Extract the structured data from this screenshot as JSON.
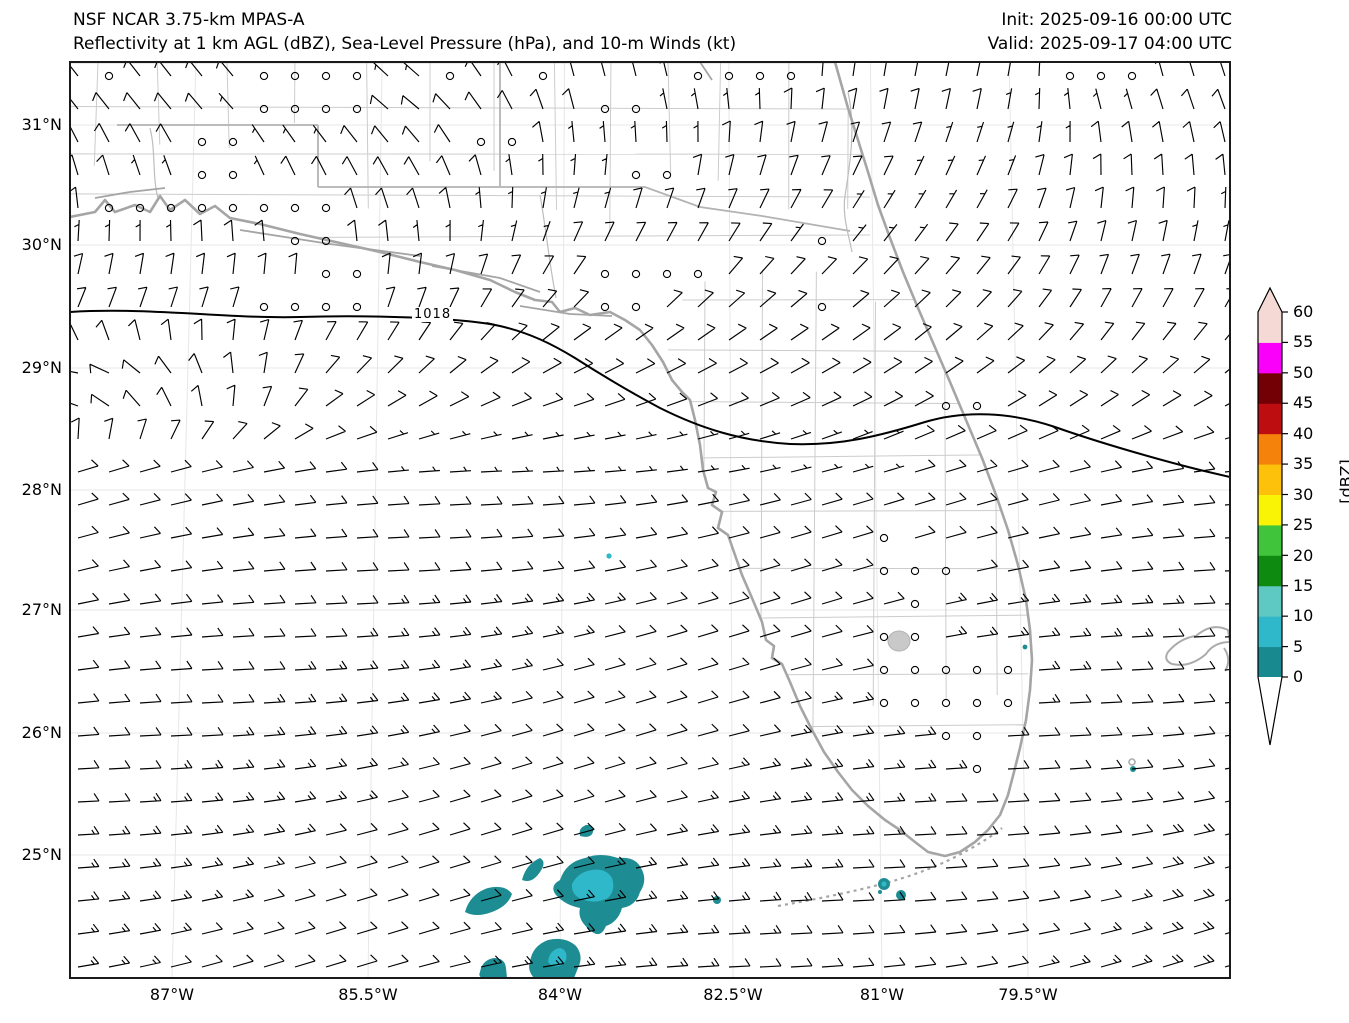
{
  "header": {
    "model_name": "NSF NCAR 3.75-km MPAS-A",
    "field_description": "Reflectivity at 1 km AGL (dBZ), Sea-Level Pressure (hPa), and 10-m Winds (kt)",
    "init": "Init: 2025-09-16 00:00 UTC",
    "valid": "Valid: 2025-09-17 04:00 UTC"
  },
  "map": {
    "lat_tick_labels": [
      "31°N",
      "30°N",
      "29°N",
      "28°N",
      "27°N",
      "26°N",
      "25°N"
    ],
    "lon_tick_labels": [
      "87°W",
      "85.5°W",
      "84°W",
      "82.5°W",
      "81°W",
      "79.5°W"
    ],
    "isobar_label": "1018"
  },
  "colorbar": {
    "unit_label": "[dBZ]",
    "tick_labels": [
      "60",
      "55",
      "50",
      "45",
      "40",
      "35",
      "30",
      "25",
      "20",
      "15",
      "10",
      "5",
      "0"
    ],
    "segment_colors_low_to_high": [
      "#17898f",
      "#2fb8c9",
      "#5ec8c2",
      "#0f8a10",
      "#3fc43c",
      "#f9f306",
      "#fdc10b",
      "#f5820b",
      "#bd0d10",
      "#730005",
      "#fa00fa",
      "#f5d9d5"
    ],
    "over_color": "#f5d9d5",
    "under_color": "#ffffff"
  },
  "chart_data": {
    "type": "heatmap",
    "title": "NSF NCAR 3.75-km MPAS-A — Reflectivity at 1 km AGL (dBZ), Sea-Level Pressure (hPa), and 10-m Winds (kt)",
    "init_time": "2025-09-16 00:00 UTC",
    "valid_time": "2025-09-17 04:00 UTC",
    "region": "Florida, eastern Gulf of Mexico and adjacent Atlantic",
    "x_ticks_deg_west": [
      87,
      85.5,
      84,
      82.5,
      81,
      79.5
    ],
    "y_ticks_deg_north": [
      31,
      30,
      29,
      28,
      27,
      26,
      25
    ],
    "xlim_deg_west": [
      88.0,
      77.8
    ],
    "ylim_deg_north": [
      24.0,
      31.5
    ],
    "grid": "faint graticule on",
    "legend_position": "vertical colorbar right",
    "colorbar_levels_dbz": [
      0,
      5,
      10,
      15,
      20,
      25,
      30,
      35,
      40,
      45,
      50,
      55,
      60
    ],
    "colorbar_unit": "dBZ",
    "slp_contours_hpa": [
      1018
    ],
    "wind_barb_unit": "kt",
    "wind_regimes": [
      {
        "area": "south of ~28.5N (Gulf waters and Florida Straits)",
        "direction_from": "E to ENE",
        "speed_kt": "10-15, locally 20 southeast of Florida"
      },
      {
        "area": "eastern Gulf ~29-30N",
        "direction_from": "NE veering to N",
        "speed_kt": "5-10"
      },
      {
        "area": "AL/GA/north-FL land and interior south FL",
        "direction_from": "light and variable with many calms",
        "speed_kt": "0-5"
      },
      {
        "area": "Atlantic northeast of Florida",
        "direction_from": "N to NNW, anticyclonic curvature",
        "speed_kt": "5-10"
      }
    ],
    "reflectivity_cells": [
      {
        "lon": -83.7,
        "lat": 24.67,
        "dbz_max": 10,
        "note": "largest cell cluster, lighter 5-10 dBZ core"
      },
      {
        "lon": -84.56,
        "lat": 24.63,
        "dbz_max": 5
      },
      {
        "lon": -84.2,
        "lat": 24.87,
        "dbz_max": 5
      },
      {
        "lon": -83.78,
        "lat": 25.2,
        "dbz_max": 5
      },
      {
        "lon": -84.08,
        "lat": 24.16,
        "dbz_max": 10
      },
      {
        "lon": -84.53,
        "lat": 24.07,
        "dbz_max": 5
      },
      {
        "lon": -82.6,
        "lat": 24.63,
        "dbz_max": 5
      },
      {
        "lon": -81.0,
        "lat": 24.75,
        "dbz_max": 10,
        "note": "small cells near the lower Florida Keys"
      },
      {
        "lon": -79.5,
        "lat": 26.7,
        "dbz_max": 5
      },
      {
        "lon": -78.4,
        "lat": 25.7,
        "dbz_max": 5
      },
      {
        "lon": -83.58,
        "lat": 27.45,
        "dbz_max": 5
      }
    ]
  }
}
